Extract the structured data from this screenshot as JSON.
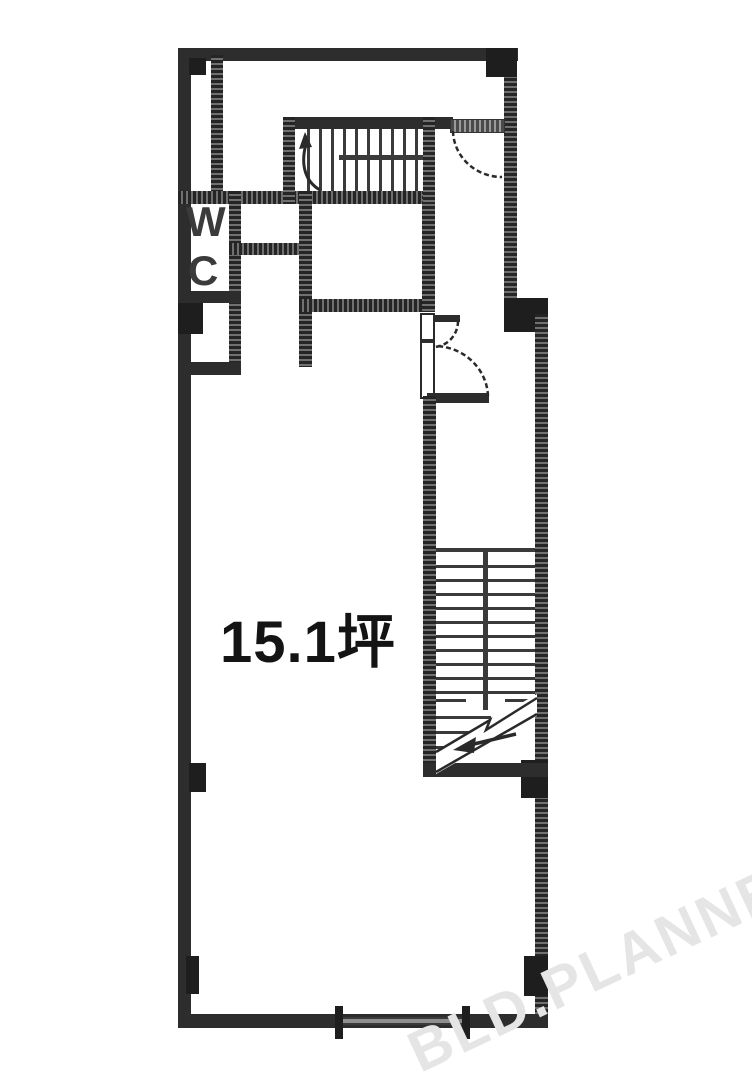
{
  "plan": {
    "area_label": "15.1坪",
    "wc_letter_top": "W",
    "wc_letter_bottom": "C",
    "watermark": "BLD.PLANNER",
    "colors": {
      "wall": "#2d2d2d",
      "background": "#ffffff",
      "watermark_gray": "#e5e5e5",
      "label_black": "#141414"
    }
  }
}
